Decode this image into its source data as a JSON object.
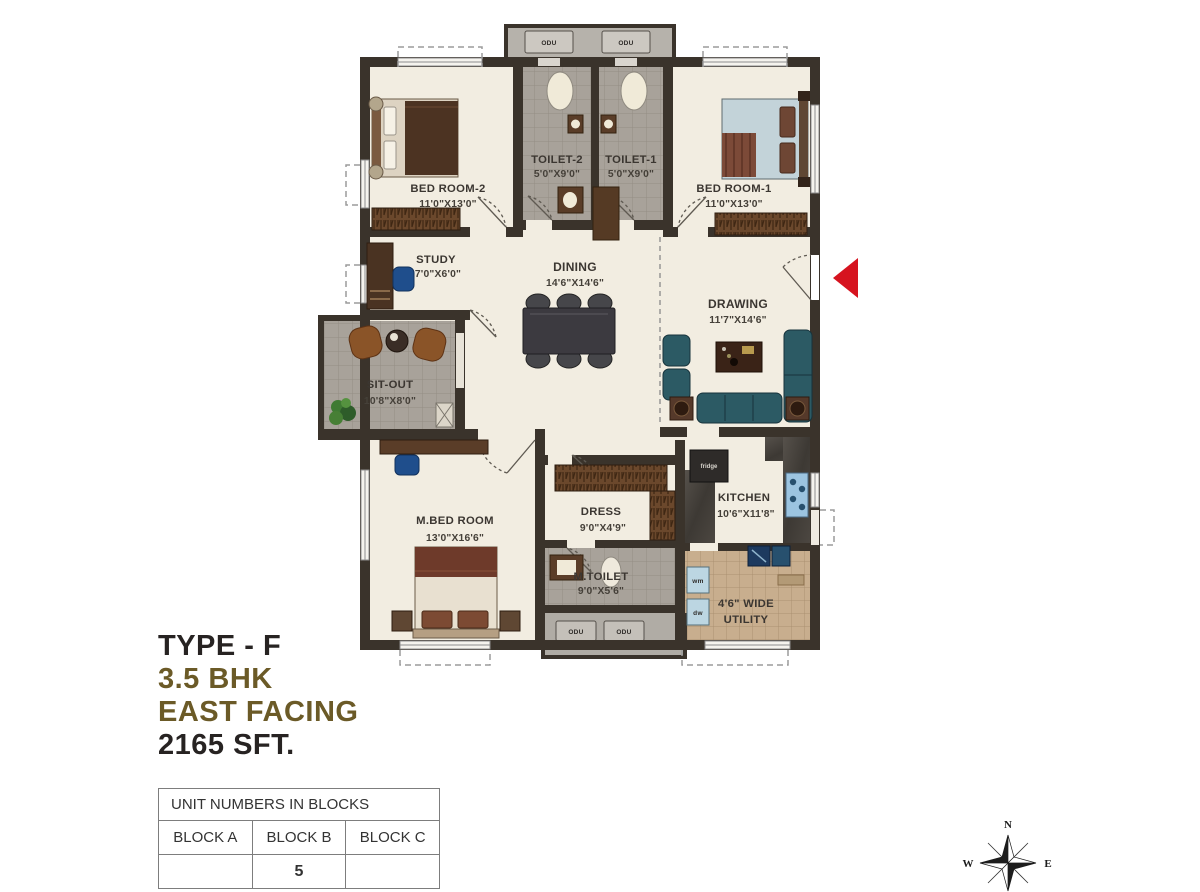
{
  "plan": {
    "odu_label": "ODU",
    "fridge_label": "fridge",
    "wm_label": "wm",
    "dw_label": "dw",
    "rooms": {
      "bedroom2": {
        "name": "BED ROOM-2",
        "dim": "11'0\"X13'0\""
      },
      "toilet2": {
        "name": "TOILET-2",
        "dim": "5'0\"X9'0\""
      },
      "toilet1": {
        "name": "TOILET-1",
        "dim": "5'0\"X9'0\""
      },
      "bedroom1": {
        "name": "BED ROOM-1",
        "dim": "11'0\"X13'0\""
      },
      "study": {
        "name": "STUDY",
        "dim": "7'0\"X6'0\""
      },
      "dining": {
        "name": "DINING",
        "dim": "14'6\"X14'6\""
      },
      "drawing": {
        "name": "DRAWING",
        "dim": "11'7\"X14'6\""
      },
      "sitout": {
        "name": "SIT-OUT",
        "dim": "10'8\"X8'0\""
      },
      "mbedroom": {
        "name": "M.BED ROOM",
        "dim": "13'0\"X16'6\""
      },
      "dress": {
        "name": "DRESS",
        "dim": "9'0\"X4'9\""
      },
      "mtoilet": {
        "name": "M.TOILET",
        "dim": "9'0\"X5'6\""
      },
      "kitchen": {
        "name": "KITCHEN",
        "dim": "10'6\"X11'8\""
      },
      "utility": {
        "name": "4'6\" WIDE",
        "dim": "UTILITY"
      }
    }
  },
  "info": {
    "type": "TYPE - F",
    "bhk": "3.5 BHK",
    "facing": "EAST FACING",
    "area": "2165 SFT."
  },
  "unit_table": {
    "title": "UNIT NUMBERS IN BLOCKS",
    "columns": [
      "BLOCK A",
      "BLOCK B",
      "BLOCK C"
    ],
    "values": [
      "",
      "5",
      ""
    ]
  },
  "compass": {
    "north": "N",
    "east": "E",
    "west": "W",
    "south": "S"
  },
  "colors": {
    "wall": "#3a332b",
    "floor": "#f2ede1",
    "tile_gray": "#a8a29a",
    "tile_beige": "#c8ae8e",
    "accent_gold": "#6b5a27",
    "text_dark": "#272322",
    "entry_arrow": "#d6131f",
    "sofa_teal": "#2c5a64",
    "wood_brown": "#6b482c"
  }
}
